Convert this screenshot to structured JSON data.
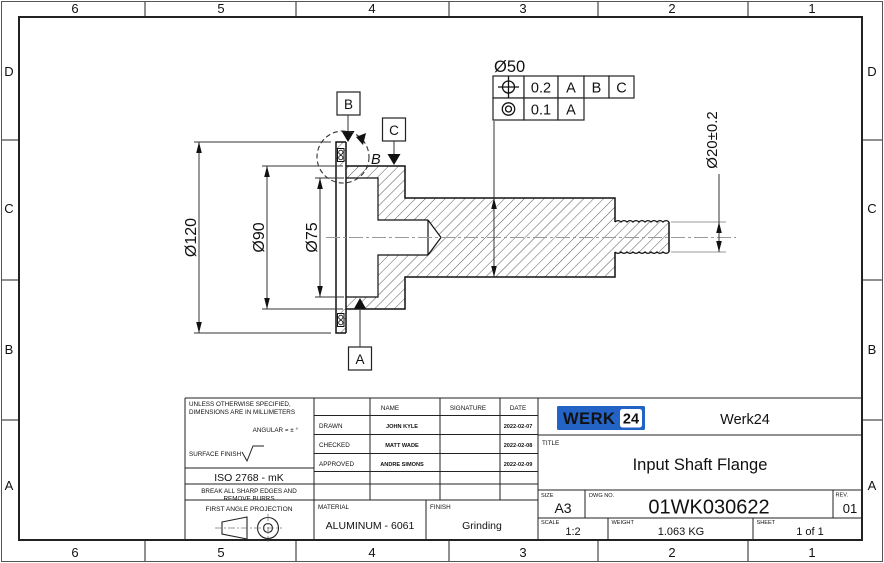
{
  "sheet": {
    "zone_cols": [
      "6",
      "5",
      "4",
      "3",
      "2",
      "1"
    ],
    "zone_rows": [
      "D",
      "C",
      "B",
      "A"
    ]
  },
  "drawing": {
    "dim_d120": "Ø120",
    "dim_d90": "Ø90",
    "dim_d75": "Ø75",
    "dim_d50": "Ø50",
    "dim_d20": "Ø20±0.2",
    "datum_a": "A",
    "datum_b": "B",
    "datum_c": "C",
    "detail_label": "B",
    "fcf": {
      "position_symbol": "position-tolerance",
      "position_tolerance": "0.2",
      "position_datum_1": "A",
      "position_datum_2": "B",
      "position_datum_3": "C",
      "concentricity_symbol": "concentricity",
      "concentricity_tolerance": "0.1",
      "concentricity_datum_1": "A"
    }
  },
  "titleblock": {
    "notes_line1": "UNLESS OTHERWISE SPECIFIED,",
    "notes_line2": "DIMENSIONS ARE IN MILLIMETERS",
    "angular_note": "ANGULAR = ± °",
    "surface_finish_label": "SURFACE FINISH",
    "tolerance_standard": "ISO 2768 - mK",
    "deburr_line1": "BREAK ALL SHARP EDGES AND",
    "deburr_line2": "REMOVE BURRS",
    "projection_label": "FIRST ANGLE PROJECTION",
    "col_name": "NAME",
    "col_signature": "SIGNATURE",
    "col_date": "DATE",
    "rows": [
      {
        "role": "DRAWN",
        "name": "JOHN KYLE",
        "date": "2022-02-07"
      },
      {
        "role": "CHECKED",
        "name": "MATT WADE",
        "date": "2022-02-08"
      },
      {
        "role": "APPROVED",
        "name": "ANDRE SIMONS",
        "date": "2022-02-09"
      }
    ],
    "material_label": "MATERIAL",
    "material_value": "ALUMINUM - 6061",
    "finish_label": "FINISH",
    "finish_value": "Grinding",
    "brand": {
      "logo_text": "WERK",
      "logo_badge": "24",
      "company": "Werk24",
      "blue": "#2363c5"
    },
    "title_label": "TITLE",
    "title_value": "Input Shaft Flange",
    "size_label": "SIZE",
    "size_value": "A3",
    "dwg_label": "DWG NO.",
    "dwg_value": "01WK030622",
    "rev_label": "REV.",
    "rev_value": "01",
    "scale_label": "SCALE",
    "scale_value": "1:2",
    "weight_label": "WEIGHT",
    "weight_value": "1.063 KG",
    "sheet_label": "SHEET",
    "sheet_value": "1 of 1"
  }
}
